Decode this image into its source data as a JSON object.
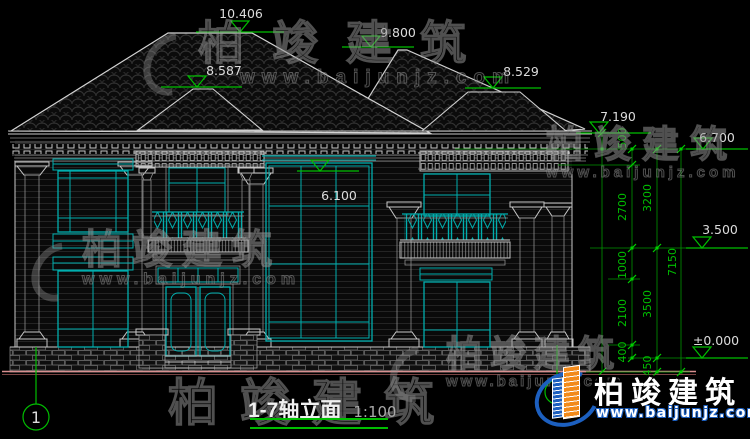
{
  "page": {
    "width": 750,
    "height": 439,
    "background": "#000000"
  },
  "drawing": {
    "title": "1-7轴立面",
    "scale": "1:100",
    "elevation_markers": [
      {
        "name": "main-roof-ridge",
        "value": "10.406"
      },
      {
        "name": "right-roof-ridge",
        "value": "9.800"
      },
      {
        "name": "left-porch-roof",
        "value": "8.587"
      },
      {
        "name": "right-porch-roof",
        "value": "8.529"
      },
      {
        "name": "eave-level",
        "value": "7.190"
      },
      {
        "name": "upper-window-top",
        "value": "6.700"
      },
      {
        "name": "curtain-wall-top",
        "value": "6.100"
      },
      {
        "name": "second-floor-level",
        "value": "3.500"
      },
      {
        "name": "ground-floor-level",
        "value": "±0.000"
      }
    ],
    "vertical_dimensions": [
      {
        "value": "500"
      },
      {
        "value": "2700"
      },
      {
        "value": "1000"
      },
      {
        "value": "2100"
      },
      {
        "value": "400"
      },
      {
        "value": "3200"
      },
      {
        "value": "3500"
      },
      {
        "value": "450"
      },
      {
        "value": "7150"
      }
    ],
    "axis_bubbles": [
      {
        "label": "1"
      },
      {
        "label": "7"
      }
    ],
    "colors": {
      "window_teal": "#00AEAE",
      "dimension_green": "#00BE00",
      "ground_pink": "#D98F8F",
      "line_white": "#C8C8C8",
      "logo_blue": "#1C5FBF",
      "logo_orange": "#F28A1A"
    }
  },
  "watermark": {
    "brand": "柏竣建筑",
    "url": "www.baijunjz.com"
  },
  "logo": {
    "brand": "柏竣建筑",
    "url": "www.baijunjz.com"
  }
}
